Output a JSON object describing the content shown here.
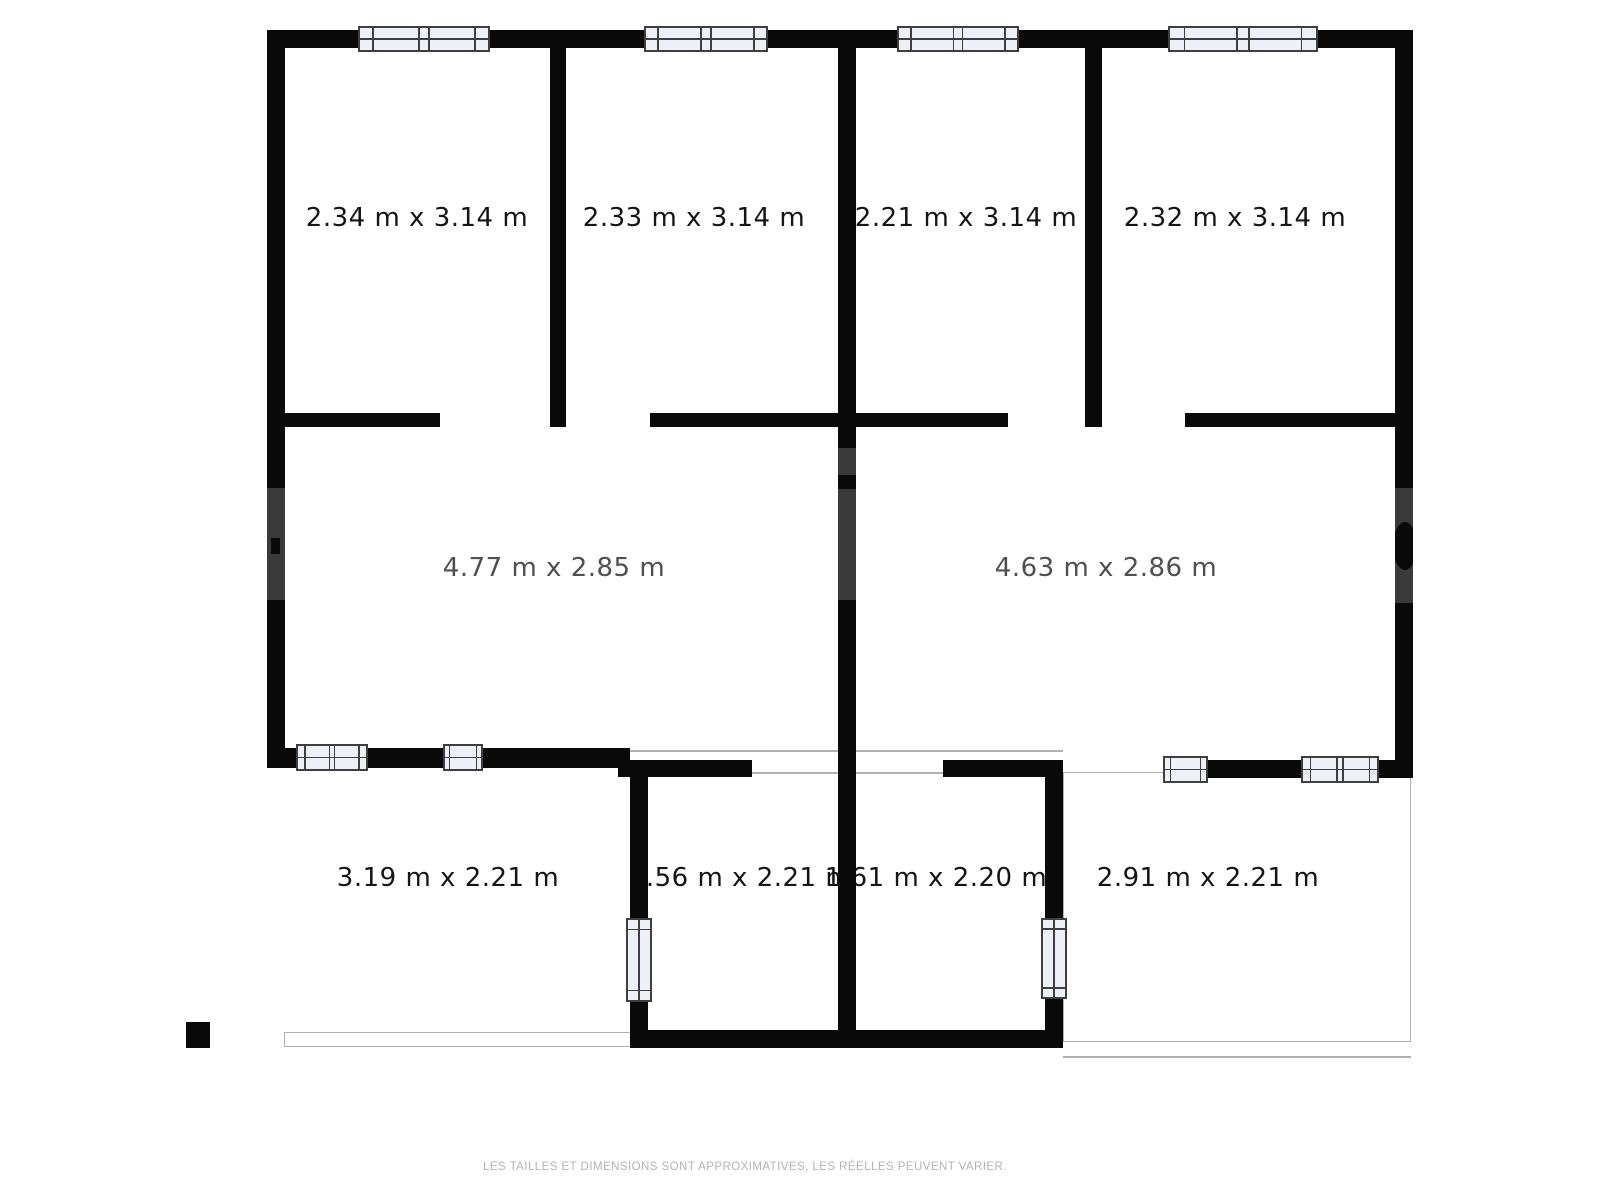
{
  "plan": {
    "rooms": [
      {
        "name": "top-room-1",
        "label": "2.34 m x 3.14 m"
      },
      {
        "name": "top-room-2",
        "label": "2.33 m x 3.14 m"
      },
      {
        "name": "top-room-3",
        "label": "2.21 m x 3.14 m"
      },
      {
        "name": "top-room-4",
        "label": "2.32 m x 3.14 m"
      },
      {
        "name": "middle-room-left",
        "label": "4.77 m x 2.85 m"
      },
      {
        "name": "middle-room-right",
        "label": "4.63 m x 2.86 m"
      },
      {
        "name": "bottom-area-left",
        "label": "3.19 m x 2.21 m"
      },
      {
        "name": "bottom-room-center-left",
        "label": "1.56 m x 2.21 m"
      },
      {
        "name": "bottom-room-center-right",
        "label": "1.61 m x 2.20 m"
      },
      {
        "name": "bottom-area-right",
        "label": "2.91 m x 2.21 m"
      }
    ],
    "disclaimer": "LES TAILLES ET DIMENSIONS SONT APPROXIMATIVES, LES RÉELLES PEUVENT VARIER.",
    "colors": {
      "wall": "#0a0a0a",
      "window_fill": "#eef0f8",
      "window_line": "#3f3f3f",
      "terrace_line": "#b0b0b0",
      "label": "#151515",
      "label_muted": "#4f4f4f",
      "disclaimer_text": "#b3b3b3",
      "watermark_shadow": "#3a3a3a"
    }
  }
}
